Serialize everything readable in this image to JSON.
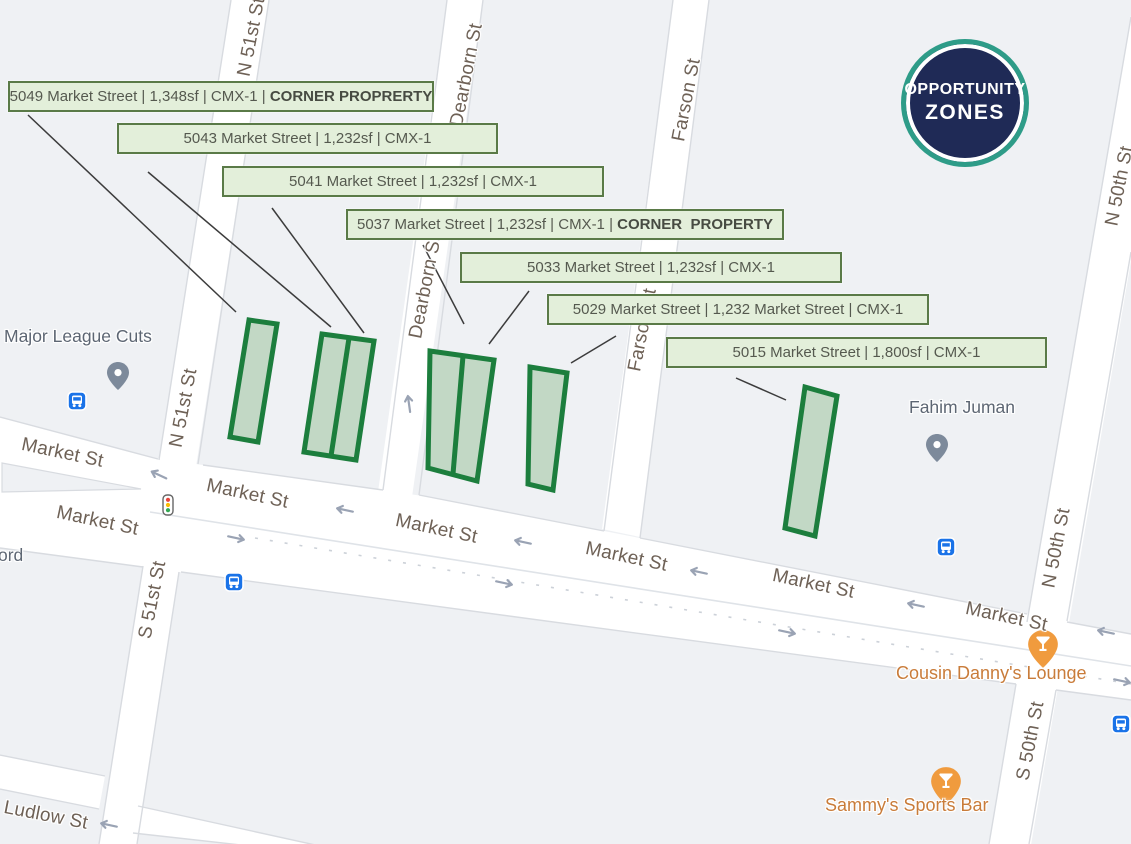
{
  "badge": {
    "line1": "OPPORTUNITY",
    "line2": "ZONES"
  },
  "property_labels": [
    {
      "main": "5049 Market Street | 1,348sf | CMX-1 | ",
      "bold": "CORNER PROPRERTY"
    },
    {
      "main": "5043 Market Street | 1,232sf | CMX-1",
      "bold": ""
    },
    {
      "main": "5041 Market Street | 1,232sf | CMX-1",
      "bold": ""
    },
    {
      "main": "5037 Market Street | 1,232sf | CMX-1 | ",
      "bold": "CORNER  PROPERTY"
    },
    {
      "main": "5033 Market Street | 1,232sf | CMX-1",
      "bold": ""
    },
    {
      "main": "5029 Market Street | 1,232 Market Street | CMX-1",
      "bold": ""
    },
    {
      "main": "5015 Market Street | 1,800sf | CMX-1",
      "bold": ""
    }
  ],
  "street_labels": [
    {
      "text": "Market St"
    },
    {
      "text": "Market St"
    },
    {
      "text": "Market St"
    },
    {
      "text": "Market St"
    },
    {
      "text": "Market St"
    },
    {
      "text": "Market St"
    },
    {
      "text": "Market St"
    },
    {
      "text": "N 51st St"
    },
    {
      "text": "N 51st St"
    },
    {
      "text": "Dearborn St"
    },
    {
      "text": "Dearborn St"
    },
    {
      "text": "Farson St"
    },
    {
      "text": "Farson St"
    },
    {
      "text": "N 50th St"
    },
    {
      "text": "N 50th St"
    },
    {
      "text": "S 50th St"
    },
    {
      "text": "S 51st St"
    },
    {
      "text": "Ludlow St"
    }
  ],
  "pois": [
    {
      "name": "Major League Cuts",
      "type": "gray-pin"
    },
    {
      "name": "Fahim Juman",
      "type": "gray-pin"
    },
    {
      "name": "Cousin Danny's Lounge",
      "type": "orange-bar-pin"
    },
    {
      "name": "Sammy's Sports Bar",
      "type": "orange-bar-pin"
    },
    {
      "name": "ord",
      "type": "partial-label-cut-at-edge"
    }
  ],
  "icons": {
    "bus": "bus-stop-icon",
    "gray_pin": "map-pin-icon",
    "bar_pin": "cocktail-pin-icon",
    "traffic_light": "traffic-light-icon",
    "one_way": "one-way-arrow-icon"
  },
  "colors": {
    "parcel_fill": "#c2d8c5",
    "parcel_border": "#1c7e3d",
    "label_box_bg": "#e3efda",
    "label_box_border": "#5a7a47",
    "badge_navy": "#1f2a56",
    "badge_teal": "#2e9c88",
    "transit_blue": "#1a73e8",
    "poi_orange": "#c97c3a",
    "road_white": "#ffffff",
    "block_gray": "#eff1f4"
  }
}
